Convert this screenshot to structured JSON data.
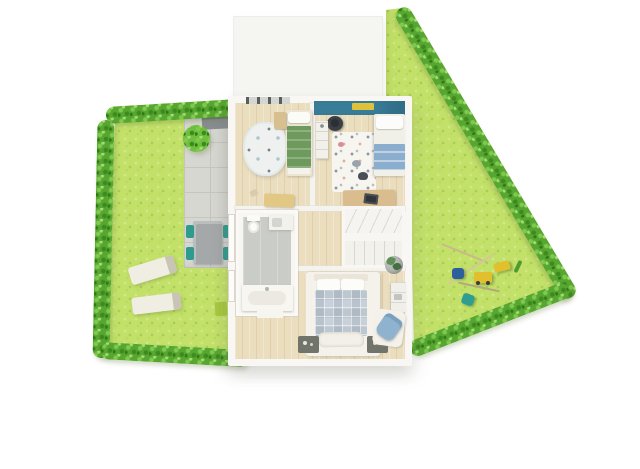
{
  "scene": {
    "kind": "3d-floor-plan-top-down-render",
    "background": "#ffffff"
  },
  "colors": {
    "lawn": "#c3e169",
    "hedge": "#57a631",
    "hedge-light": "#7ec94e",
    "hedge-dark": "#3d8a1e",
    "bush": "#6fbf3f",
    "patio": "#d7d7d2",
    "patio-line": "#c5c6c0",
    "table-grey": "#a4a8a9",
    "chair-teal": "#2e9b8e",
    "lounger": "#f0ede3",
    "house-wall": "#f8f7f3",
    "garage-roof": "#f5f5f2",
    "wood": "#ebdebf",
    "accent-teal-wall": "#3d84a0",
    "shelf-yellow": "#dfc23b",
    "blanket-green": "#6f9a5e",
    "blanket-blue": "#8badce",
    "duvet-blue-grey": "#c8d1d9",
    "rug-white": "#f4f2ea",
    "bath-floor": "#c9ccc7",
    "furniture-tan": "#d9bd8e",
    "bench-yellow": "#e2c885",
    "nightstand-dark": "#70746a",
    "armchair-blue": "#8fb2cf",
    "chair-black": "#3a3f46",
    "toy-yellow": "#e2bf2c",
    "toy-blue": "#2d5f9e",
    "toy-teal": "#2f9d8f",
    "plant-green": "#5d8f57",
    "pot-grey": "#b7bbb7",
    "mat-green": "#a6c93f"
  },
  "inventory": {
    "garage": [
      "flat-roof"
    ],
    "garden_left": [
      "hedge-border-top",
      "hedge-border-left",
      "hedge-border-bottom",
      "lawn",
      "round-bush",
      "stone-patio",
      "patio-bench",
      "outdoor-table",
      "teal-chairs-x4",
      "sun-lounger-x2",
      "green-mat"
    ],
    "garden_right": [
      "hedge-border-diagonal",
      "hedge-border-bottom",
      "lawn",
      "watering-can",
      "teal-toy",
      "toy-truck",
      "toy-bench",
      "garden-stick",
      "rake-sticks"
    ],
    "house": {
      "kids_bedroom_left": [
        "single-bed-green-blanket",
        "pillow",
        "headboard-cabinet",
        "cloud-play-rug",
        "storage-bench",
        "slipper",
        "window-top"
      ],
      "kids_bedroom_right": [
        "teal-accent-wall",
        "yellow-wall-shelf",
        "black-desk-chair",
        "shelf-unit",
        "pattern-rug",
        "single-bed-blue-blanket",
        "desk",
        "laptop"
      ],
      "bathroom": [
        "toilet",
        "washbasin-cabinet",
        "shower-floor",
        "vanity-sink",
        "vanity-extension"
      ],
      "staircase": [
        "winder-steps",
        "mid-landing",
        "straight-flight"
      ],
      "hallway": [
        "wood-floor"
      ],
      "master_bedroom": [
        "double-bed",
        "headboard",
        "pillow-x2",
        "checkered-duvet",
        "foot-blanket",
        "area-rug",
        "nightstand-x2",
        "potted-plant",
        "dresser",
        "blue-armchair",
        "armchair-rug"
      ],
      "windows": [
        "window-left-upper",
        "window-left-lower"
      ]
    }
  }
}
